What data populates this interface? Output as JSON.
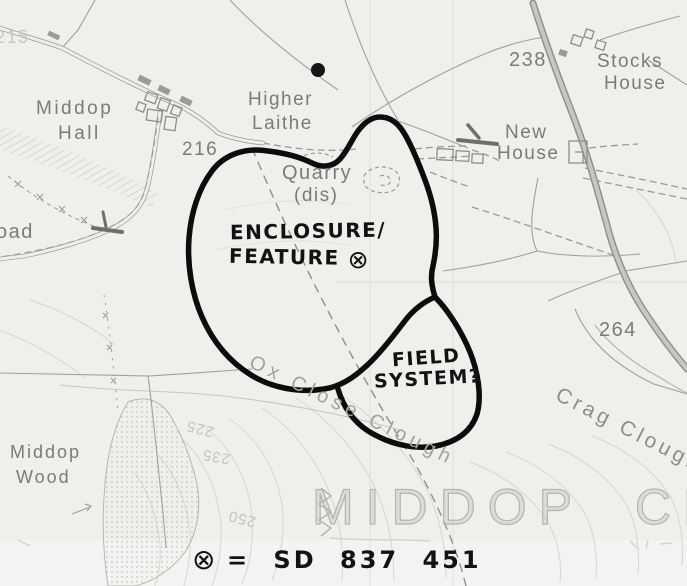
{
  "map_labels": {
    "spot_215": "215",
    "spot_216": "216",
    "spot_238": "238",
    "spot_264": "264",
    "middop_hall_1": "Middop",
    "middop_hall_2": "Hall",
    "higher_laithe_1": "Higher",
    "higher_laithe_2": "Laithe",
    "quarry": "Quarry",
    "quarry_dis": "(dis)",
    "new_house_1": "New",
    "new_house_2": "House",
    "stocks_house_1": "Stocks",
    "stocks_house_2": "House",
    "middop_wood_1": "Middop",
    "middop_wood_2": "Wood",
    "crag_clough": "Crag Clough",
    "ox_close_clough": "Ox Close Clough",
    "middop_cp": "MIDDOP CP",
    "road_partial": "oad",
    "contour_225": "225",
    "contour_235": "235",
    "contour_250": "250"
  },
  "annotations": {
    "enclosure_line1": "ENCLOSURE/",
    "enclosure_line2": "FEATURE",
    "target_symbol": "⊗",
    "field_line1": "FIELD",
    "field_line2": "SYSTEM?",
    "legend_symbol": "⊗",
    "legend_text": "= SD 837 451"
  },
  "colors": {
    "annotation_ink": "#121212",
    "map_line_gray": "#9a9a9a",
    "contour_gray": "#d8d5cd"
  }
}
